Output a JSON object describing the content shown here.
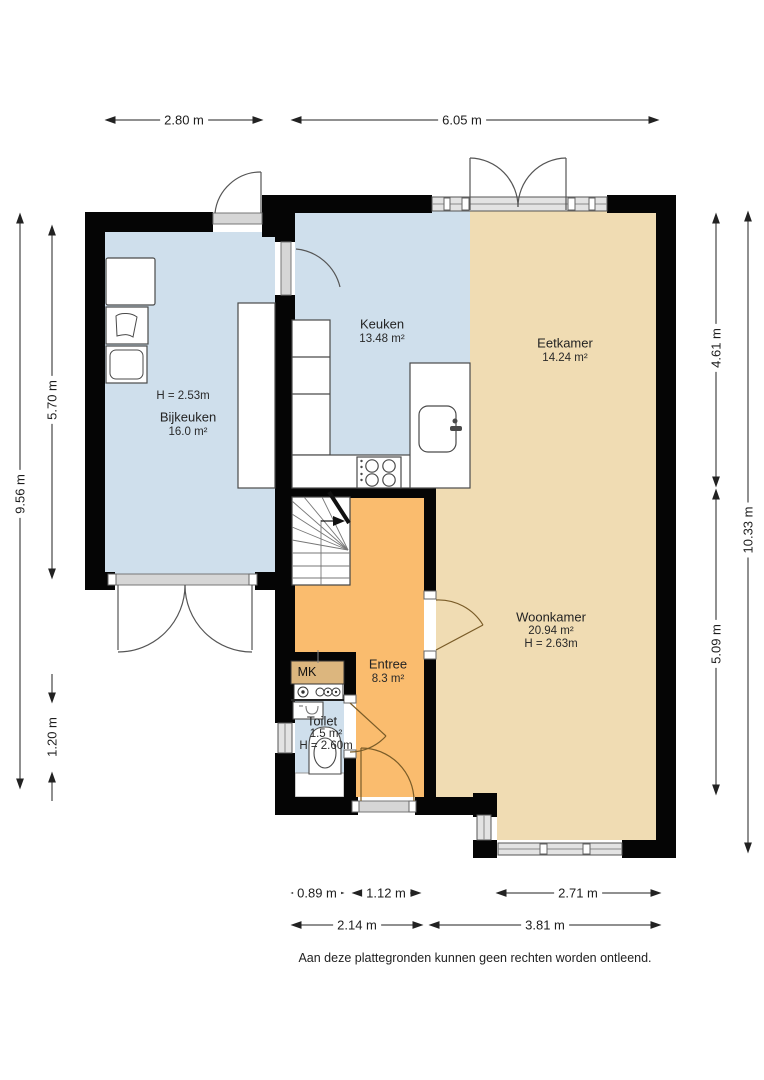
{
  "rooms": {
    "bijkeuken": {
      "name": "Bijkeuken",
      "area": "16.0 m²",
      "ceiling": "H = 2.53m"
    },
    "keuken": {
      "name": "Keuken",
      "area": "13.48 m²"
    },
    "eetkamer": {
      "name": "Eetkamer",
      "area": "14.24 m²"
    },
    "woonkamer": {
      "name": "Woonkamer",
      "area": "20.94 m²",
      "ceiling": "H = 2.63m"
    },
    "entree": {
      "name": "Entree",
      "area": "8.3 m²"
    },
    "toilet": {
      "name": "Toilet",
      "area": "1.5 m²",
      "ceiling": "H = 2.60m"
    },
    "meterkast": {
      "name": "MK"
    }
  },
  "dimensions": {
    "top": {
      "left": "2.80 m",
      "right": "6.05 m"
    },
    "left": {
      "outer": "9.56 m",
      "upper": "5.70 m",
      "lower": "1.20 m"
    },
    "right": {
      "upper": "4.61 m",
      "lower": "5.09 m",
      "outer": "10.33 m"
    },
    "bottom": {
      "row1": [
        "0.89 m",
        "1.12 m",
        "2.71 m"
      ],
      "row2": [
        "2.14 m",
        "3.81 m"
      ]
    }
  },
  "footer": {
    "disclaimer": "Aan deze plattegronden kunnen geen rechten worden ontleend."
  },
  "colors": {
    "walls": "#050505",
    "wet_rooms_floor": "#cfdfec",
    "living_floor": "#f0dcb3",
    "hall_floor": "#fabc6e",
    "meter_cabinet": "#dcb67e",
    "window_glass": "#e3e3e3"
  }
}
